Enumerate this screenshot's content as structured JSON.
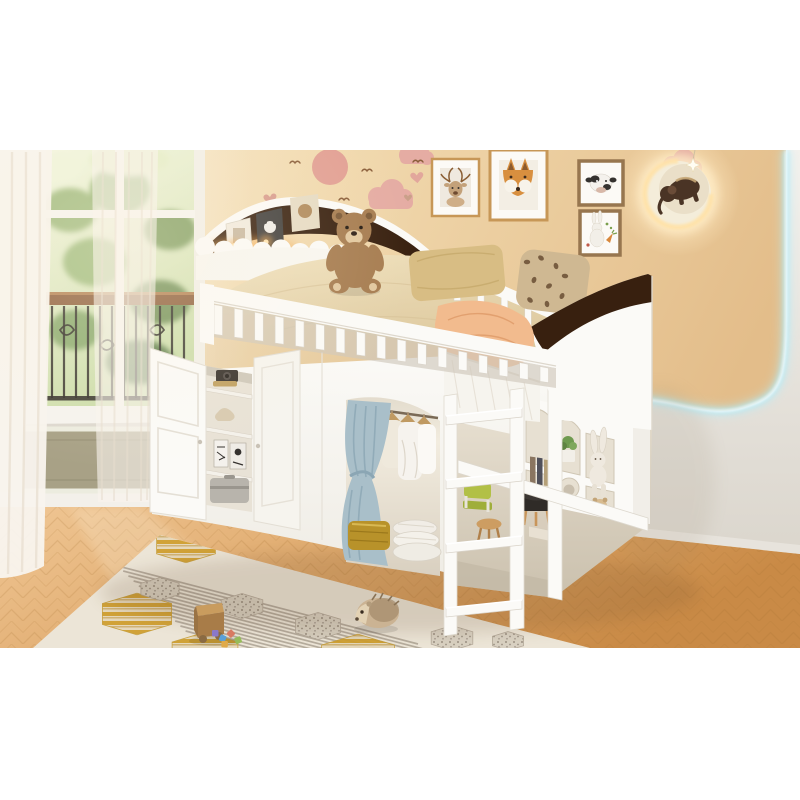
{
  "meta": {
    "type": "product-photo",
    "subject": "White kids loft bed with cloud bookshelf headboard, guardrail, under-bed wardrobe with blue curtain, open storage cabinet, cubby shelves, ladder, teddy bear, in a beige children's room with window, picture frames, moon wall lamp, herringbone floor and patterned rug",
    "canvas": {
      "width": 800,
      "height": 800
    },
    "photo_area": {
      "x": 0,
      "y": 150,
      "width": 800,
      "height": 498
    }
  },
  "palette": {
    "page_bg": "#ffffff",
    "wall_beige_light": "#f9ecd0",
    "wall_beige": "#f1d9ae",
    "wall_beige_deep": "#e3bd8a",
    "wall_left_light": "#f7f0e3",
    "wall_gray_light": "#f3f1ed",
    "wall_gray_deep": "#dbd6cd",
    "led_glow": "#b5ecf8",
    "floor_light": "#f0c795",
    "floor_mid": "#dfa96c",
    "floor_deep": "#c98a46",
    "floor_seam": "#a5702f",
    "furniture_white": "#fbfaf7",
    "furniture_shade": "#eceae3",
    "furniture_deep": "#d7d1c7",
    "walnut_dark": "#38200f",
    "walnut_warm": "#7a4418",
    "amber_glow": "#f5a94e",
    "led_dot": "#ffe3b0",
    "bedding": "#e9d9b4",
    "bedding_deep": "#d9c498",
    "mattress_white": "#f6f4ee",
    "pillow_tan": "#d8bd84",
    "pillow_leopard": "#cfb892",
    "leopard_spot": "#6e5338",
    "blanket_peach": "#f2bb8e",
    "teddy_brown": "#a67c50",
    "teddy_dark": "#7c5a38",
    "teddy_muzzle": "#e2c89f",
    "curtain_sheer": "#f8f4ed",
    "curtain_fold": "#e8decf",
    "wardrobe_curtain_blue": "#a9bfc9",
    "wardrobe_curtain_deep": "#8ba6b4",
    "clothes_white": "#f6f3ee",
    "hanger_wood": "#c09a62",
    "blanket_gold": "#b8922a",
    "quilt_white": "#f1ede6",
    "wainscot_olive": "#a8a186",
    "greenery_light": "#e4edc6",
    "greenery_mid": "#9cb878",
    "greenery_deep": "#5f7f49",
    "iron_black": "#26211b",
    "rail_wood": "#8a5a33",
    "rug_base": "#f2ece0",
    "rug_stripe_gray": "#aaa295",
    "rug_gold": "#d3a32f",
    "rug_gold_pale": "#eadfc0",
    "rug_hex_gray": "#ddd6c9",
    "rug_speckle": "#9a9184",
    "frame_gold": "#c79757",
    "frame_brown": "#97764f",
    "frame_mat": "#fcfaf6",
    "art_fox_orange": "#d88f3f",
    "art_deer_tan": "#c3a17a",
    "art_ink": "#35322f",
    "art_green": "#7ba04e",
    "art_carrot": "#d8883c",
    "moon_body": "#f4edda",
    "moon_inner": "#eadfc8",
    "elephant_brown": "#4a3425",
    "star_white": "#fffdf2",
    "decal_pink": "#e5aca3",
    "decal_pink_deep": "#e09d92",
    "heart_pink": "#d89b8d",
    "heart_tan": "#ad7e62",
    "bird_brown": "#8a5e3a",
    "toy_wood": "#c99c5e",
    "toy_wood_deep": "#a87c48",
    "hedgehog_body": "#cbb393",
    "hedgehog_dark": "#a58c6c",
    "stool_dark": "#3c3733",
    "stool_wood": "#cd9d62",
    "chair_green": "#b2c046",
    "plant_green": "#6f9a4f",
    "cubby_cut": "#e7e0d2",
    "interior_shade": "#d9d0bf"
  },
  "counts": {
    "guardrail_slats": 17,
    "back_rail_slats": 6,
    "ladder_steps": 4,
    "scallop_bumps": 8,
    "rug_stripes": 14,
    "iron_bars": 12
  },
  "layout_lines": {
    "guardrail": {
      "x0": 214,
      "x1": 540,
      "top_base": 303,
      "top_slope": 0.19,
      "bot_base": 333,
      "bot_slope": 0.145,
      "slat_w": 8.5
    },
    "back_rail": {
      "x0": 454,
      "x1": 572,
      "top_base": 268,
      "top_slope": 0.42,
      "slat_h": 30,
      "slat_w": 6.5
    },
    "ladder": {
      "step_x0": 446,
      "step_x1": 522,
      "first_y": 416,
      "dy": 64,
      "rise": 8,
      "thick": 9
    },
    "scallop": {
      "x0": 205,
      "dx": 19,
      "y0": 247,
      "dy": 0.6,
      "r": 10
    },
    "rug_stripes": {
      "x0": 118,
      "y0": 566,
      "dx": 5.2,
      "dy": 5.0,
      "len_x": 300,
      "len_y": 78
    }
  },
  "rug": {
    "hexagons": [
      {
        "cx": 186,
        "cy": 545,
        "r": 34,
        "kind": "gold"
      },
      {
        "cx": 137,
        "cy": 614,
        "r": 40,
        "kind": "gold"
      },
      {
        "cx": 205,
        "cy": 652,
        "r": 38,
        "kind": "gold"
      },
      {
        "cx": 358,
        "cy": 656,
        "r": 42,
        "kind": "gold"
      },
      {
        "cx": 160,
        "cy": 589,
        "r": 22,
        "kind": "gray"
      },
      {
        "cx": 242,
        "cy": 606,
        "r": 24,
        "kind": "gray"
      },
      {
        "cx": 318,
        "cy": 626,
        "r": 26,
        "kind": "gray"
      },
      {
        "cx": 452,
        "cy": 638,
        "r": 24,
        "kind": "gray"
      },
      {
        "cx": 508,
        "cy": 641,
        "r": 18,
        "kind": "gray"
      }
    ]
  },
  "decor": {
    "leopard_spots": [
      [
        527,
        262
      ],
      [
        541,
        258
      ],
      [
        556,
        266
      ],
      [
        534,
        280
      ],
      [
        549,
        286
      ],
      [
        565,
        276
      ],
      [
        530,
        300
      ],
      [
        547,
        304
      ],
      [
        562,
        296
      ]
    ],
    "toy_blocks": {
      "colors": [
        "#8a78c8",
        "#5aa0d8",
        "#d87a62",
        "#96bc5a",
        "#e0aa48"
      ],
      "positions": [
        [
          212,
          630
        ],
        [
          221,
          634
        ],
        [
          231,
          629
        ],
        [
          240,
          636
        ],
        [
          228,
          641
        ]
      ]
    },
    "birds": [
      [
        295,
        163
      ],
      [
        367,
        171
      ],
      [
        344,
        200
      ],
      [
        262,
        226
      ],
      [
        418,
        162
      ]
    ]
  },
  "objects": [
    "window-with-balcony-view",
    "sheer-curtains",
    "deer-art-frame",
    "fox-art-frame",
    "cow-art-frame",
    "rabbit-art-frame",
    "moon-wall-lamp-with-elephant",
    "pink-cloud-decals",
    "loft-bed",
    "cloud-bookshelf-headboard",
    "guardrail",
    "teddy-bear",
    "tan-pillow",
    "leopard-pillow",
    "arched-footboard",
    "storage-cabinet-open-doors",
    "wardrobe-with-blue-curtain",
    "hanging-clothes",
    "gold-blanket",
    "folded-quilt",
    "cubby-shelf",
    "bunny-plush",
    "ladder",
    "stools",
    "herringbone-floor",
    "patterned-rug",
    "wooden-toy-cart",
    "hedgehog-plush",
    "led-strip-wall-light"
  ]
}
